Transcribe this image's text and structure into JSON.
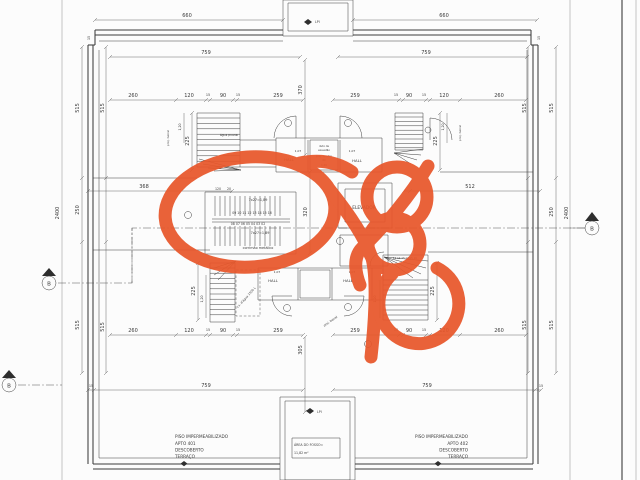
{
  "drawing": {
    "kind": "architectural terrace floor plan with freehand marker annotations",
    "paper_color": "#fcfcfc",
    "ink_color": "#3c3c3c",
    "marker_color": "#e8572b"
  },
  "dims": {
    "d660": "660",
    "d759": "759",
    "d260": "260",
    "d120": "120",
    "d15": "15",
    "d90": "90",
    "d259": "259",
    "d515": "515",
    "d370": "370",
    "d320": "320",
    "d305": "305",
    "d225": "225",
    "d250": "250",
    "d2400": "2400",
    "d368": "368",
    "d512": "512",
    "d20": "20",
    "d80": "80",
    "d107": "1,07",
    "d120c": "1,20"
  },
  "labels": {
    "elevator": "ELEVADOR",
    "hall": "HALL",
    "stair_formula": "7x27=1,89",
    "steps_up": "09 10 11 12 13 14 15 16",
    "steps_down": "08 07 06 05 04 03 02",
    "steps_small": "11 12 13 14 15 16",
    "handrail": "corrimão metálico",
    "tank": "cx. d'água 1500 L",
    "duct1": "duto de",
    "duct2": "exaustão",
    "duct3": "proj. quadro",
    "rain": "água pluvial",
    "beiral": "proj. beiral",
    "lpi": "LPI",
    "section": "B"
  },
  "apartment_left": {
    "line1": "PISO IMPERMEABILIZADO",
    "line2": "APTO 401",
    "line3": "DESCOBERTO",
    "line4": "TERRAÇO"
  },
  "apartment_right": {
    "line1": "PISO IMPERMEABILIZADO",
    "line2": "APTO 402",
    "line3": "DESCOBERTO",
    "line4": "TERRAÇO"
  },
  "fosso": {
    "title": "ÁREA DO FOSSO=",
    "value": "11,82 m²"
  },
  "annotation": {
    "color": "#e8572b"
  }
}
